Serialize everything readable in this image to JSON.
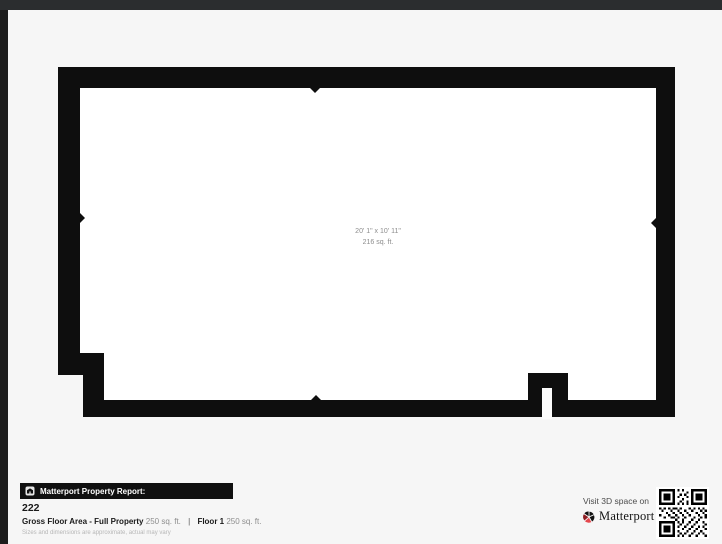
{
  "page": {
    "bg": "#f6f6f6",
    "frame_top_color": "#2b2d2f",
    "frame_left_color": "#1d1d1d"
  },
  "floorplan": {
    "wall_color": "#0e0e0e",
    "floor_color": "#ffffff",
    "room_label": {
      "dimensions": "20' 1\" x 10' 11\"",
      "area": "216 sq. ft."
    }
  },
  "footer": {
    "report_bar": {
      "label": "Matterport Property Report:",
      "icon": "building-icon",
      "bg": "#101010"
    },
    "property_name": "222",
    "metrics": {
      "gross_label": "Gross Floor Area - Full Property",
      "gross_value": "250 sq. ft.",
      "divider": "|",
      "floor_label": "Floor 1",
      "floor_value": "250 sq. ft."
    },
    "disclaimer": "Sizes and dimensions are approximate, actual may vary",
    "cta": {
      "visit_text": "Visit 3D space on",
      "brand": "Matterport",
      "trademark": "™",
      "brand_accent": "#e5474d",
      "brand_accent_dark": "#8f1d22"
    }
  }
}
